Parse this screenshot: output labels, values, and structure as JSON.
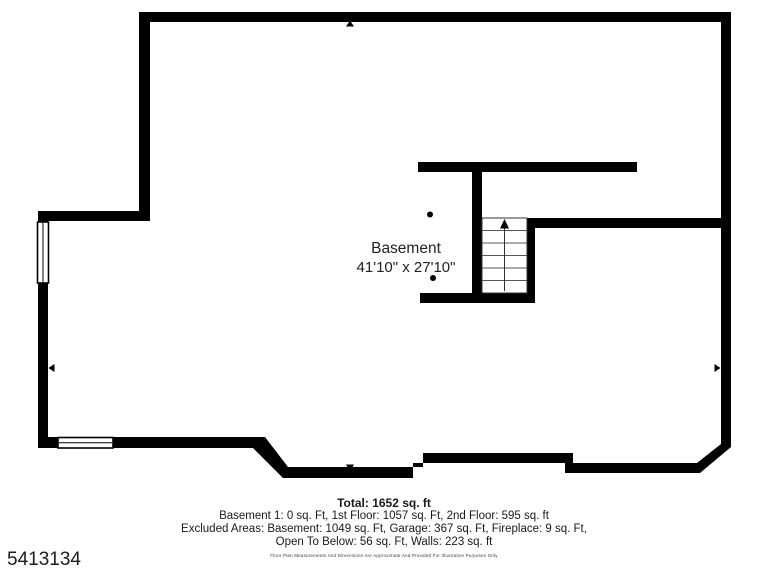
{
  "room": {
    "name": "Basement",
    "dimensions": "41'10\" x 27'10\""
  },
  "summary": {
    "total": "Total: 1652 sq. ft",
    "floors": "Basement 1: 0 sq. Ft, 1st Floor: 1057 sq. Ft, 2nd Floor: 595 sq. ft",
    "excluded": "Excluded Areas: Basement: 1049 sq. Ft, Garage: 367 sq. Ft, Fireplace: 9 sq. Ft,",
    "excluded2": "Open To Below: 56 sq. Ft, Walls: 223 sq. ft",
    "disclaimer": "Floor Plan Measurements And Dimensions Are Approximate And Provided For Illustrative Purposes Only"
  },
  "watermark": {
    "id": "5413134"
  },
  "colors": {
    "wall": "#000000",
    "text": "#1a1a1a",
    "background": "#ffffff"
  }
}
